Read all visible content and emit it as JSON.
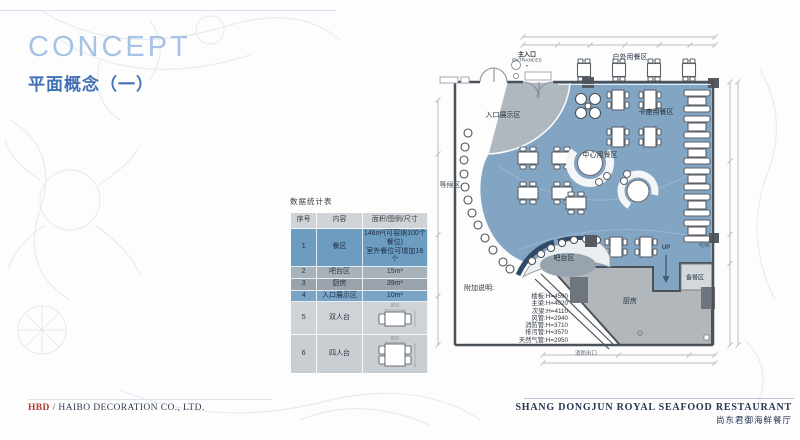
{
  "slide": {
    "title": "CONCEPT",
    "subtitle": "平面概念（一）"
  },
  "stats_table": {
    "title": "数据统计表",
    "headers": [
      "序号",
      "内容",
      "面积/图例/尺寸"
    ],
    "rows": [
      {
        "no": "1",
        "content": "餐区",
        "value": "146m²(可容纳100个餐位)\n室外餐位可增加16个"
      },
      {
        "no": "2",
        "content": "吧台区",
        "value": "15m²"
      },
      {
        "no": "3",
        "content": "厨房",
        "value": "39m²"
      },
      {
        "no": "4",
        "content": "入口展示区",
        "value": "10m²"
      },
      {
        "no": "5",
        "content": "双人台",
        "value": ""
      },
      {
        "no": "6",
        "content": "四人台",
        "value": ""
      }
    ],
    "dim_label": "800"
  },
  "floor_plan": {
    "labels": {
      "outdoor": "户外用餐区",
      "entrance": "主入口",
      "entrance_en": "ENTRANCES",
      "entrance_arrow": "⌄",
      "entrance_display": "入口展示区",
      "booth": "卡座用餐区",
      "center": "中心用餐区",
      "waiting": "等候区",
      "bar": "吧台区",
      "kitchen": "厨房",
      "prep": "备餐区",
      "up": "UP",
      "elevator": "电梯",
      "fire_exit": "消防出口"
    },
    "notes": {
      "title": "附加说明:",
      "lines": [
        "楼板:H=4590",
        "主梁:H=4020",
        "次梁:H=4110",
        "风管:H=2940",
        "消防管:H=3710",
        "排污管:H=3570",
        "天然气管:H=2950"
      ]
    }
  },
  "footer": {
    "company_brand": "HBD",
    "company_name": " / HAIBO DECORATION CO., LTD.",
    "restaurant_en": "SHANG DONGJUN ROYAL SEAFOOD RESTAURANT",
    "restaurant_cn": "尚东君御海鲜餐厅"
  },
  "colors": {
    "plan_blue": "#83a5c4",
    "title_blue": "#a6c3e5",
    "subtitle_blue": "#4272b4",
    "brand_red": "#b03a2e",
    "footer_navy": "#24374f"
  }
}
